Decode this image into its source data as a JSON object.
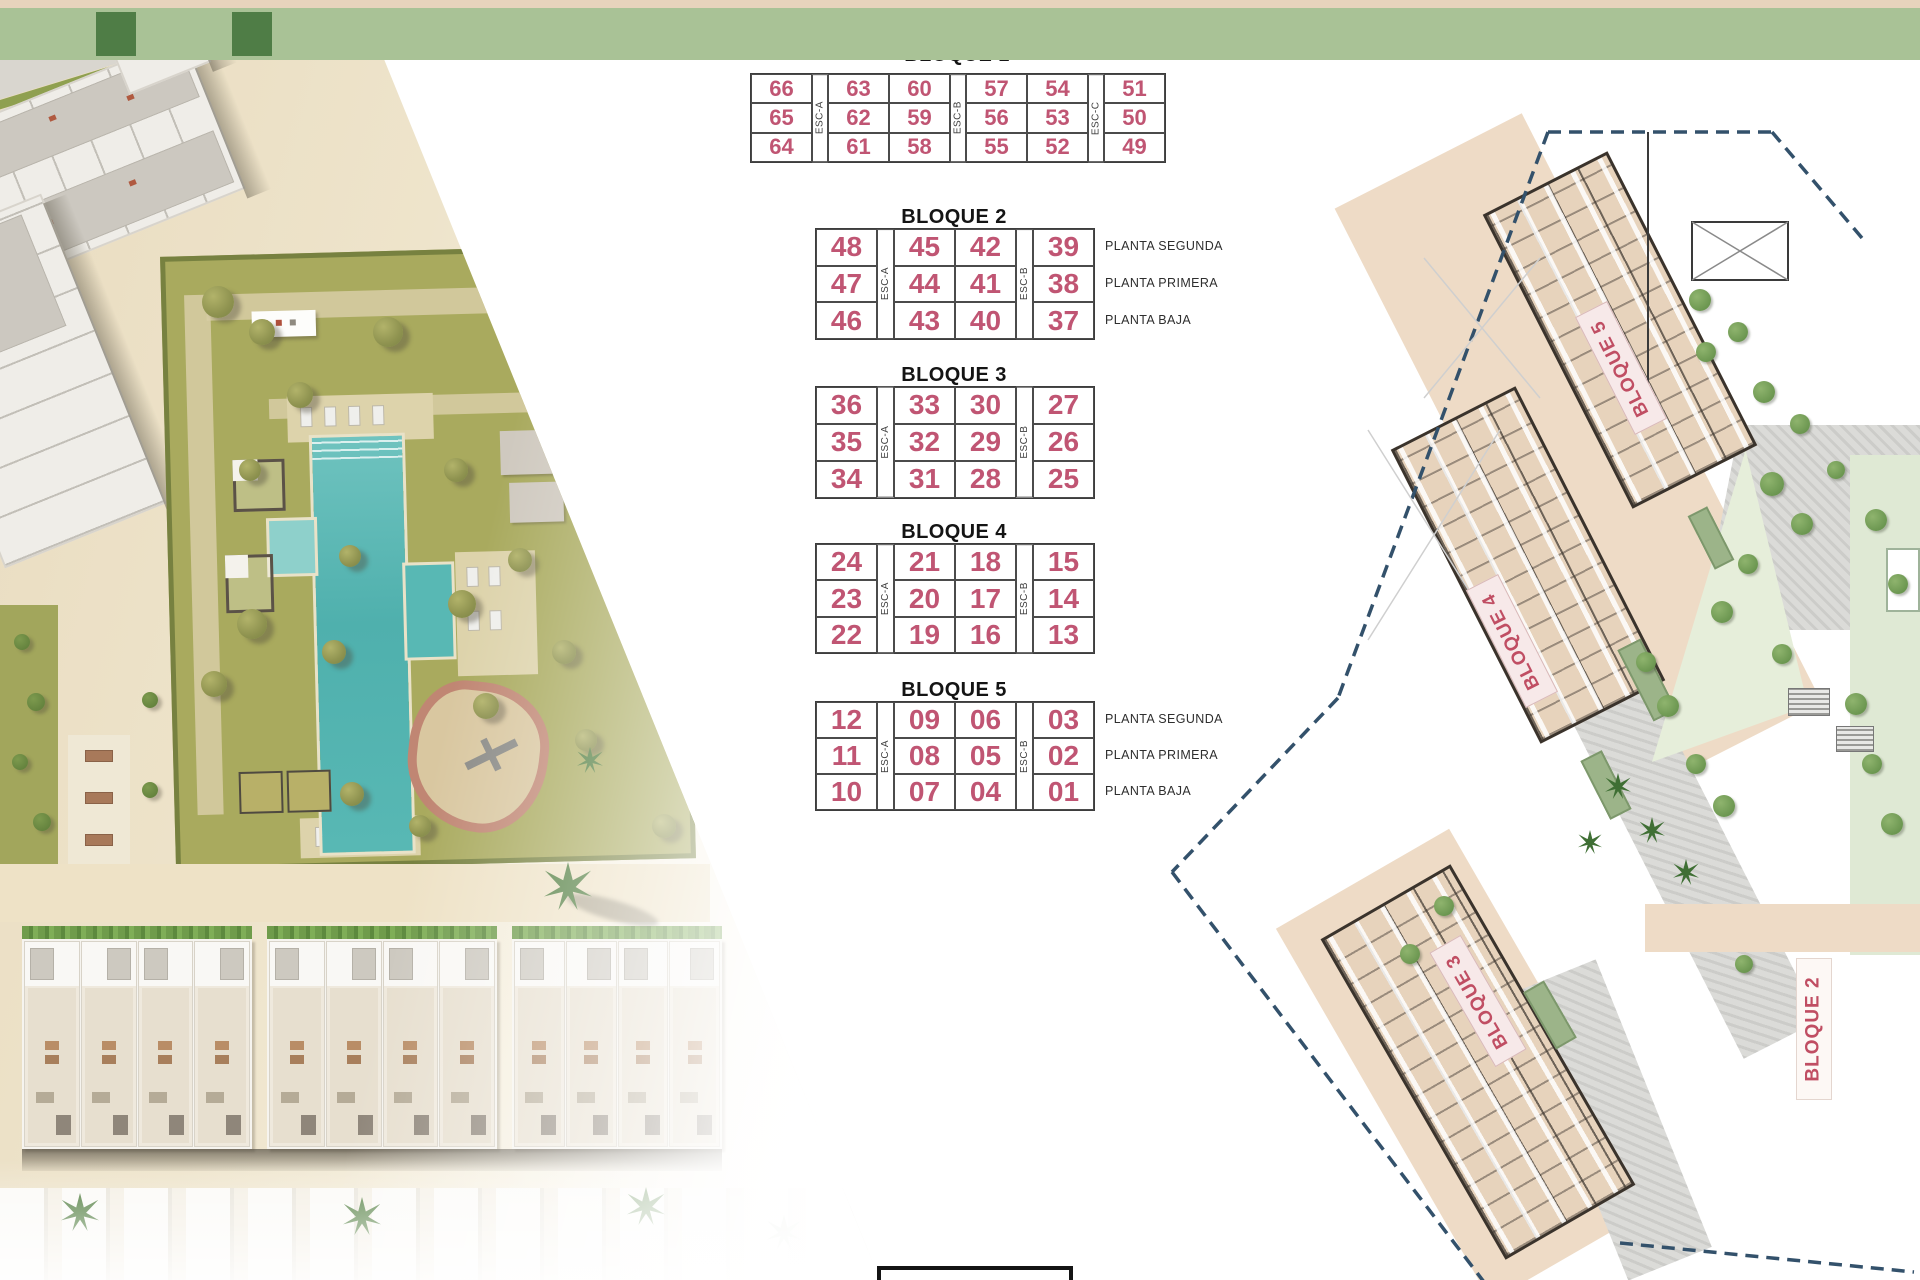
{
  "colors": {
    "accent_pink": "#c05573",
    "title_black": "#141414",
    "plan_tan": "#e7d3bc",
    "pool_turquoise": "#57b6b2",
    "boundary_navy": "#33516b",
    "lawn_green": "#a9aa5e"
  },
  "tables": {
    "bloque1": {
      "title": "BLOQUE 1",
      "esc_labels": [
        "ESC-A",
        "ESC-B",
        "ESC-C"
      ],
      "rows": [
        [
          "66",
          "63",
          "60",
          "57",
          "54",
          "51"
        ],
        [
          "65",
          "62",
          "59",
          "56",
          "53",
          "50"
        ],
        [
          "64",
          "61",
          "58",
          "55",
          "52",
          "49"
        ]
      ]
    },
    "bloque2": {
      "title": "BLOQUE 2",
      "esc_labels": [
        "ESC-A",
        "ESC-B"
      ],
      "floor_labels": [
        "PLANTA SEGUNDA",
        "PLANTA PRIMERA",
        "PLANTA BAJA"
      ],
      "rows": [
        [
          "48",
          "45",
          "42",
          "39"
        ],
        [
          "47",
          "44",
          "41",
          "38"
        ],
        [
          "46",
          "43",
          "40",
          "37"
        ]
      ]
    },
    "bloque3": {
      "title": "BLOQUE 3",
      "esc_labels": [
        "ESC-A",
        "ESC-B"
      ],
      "rows": [
        [
          "36",
          "33",
          "30",
          "27"
        ],
        [
          "35",
          "32",
          "29",
          "26"
        ],
        [
          "34",
          "31",
          "28",
          "25"
        ]
      ]
    },
    "bloque4": {
      "title": "BLOQUE 4",
      "esc_labels": [
        "ESC-A",
        "ESC-B"
      ],
      "rows": [
        [
          "24",
          "21",
          "18",
          "15"
        ],
        [
          "23",
          "20",
          "17",
          "14"
        ],
        [
          "22",
          "19",
          "16",
          "13"
        ]
      ]
    },
    "bloque5": {
      "title": "BLOQUE 5",
      "esc_labels": [
        "ESC-A",
        "ESC-B"
      ],
      "floor_labels": [
        "PLANTA SEGUNDA",
        "PLANTA PRIMERA",
        "PLANTA BAJA"
      ],
      "rows": [
        [
          "12",
          "09",
          "06",
          "03"
        ],
        [
          "11",
          "08",
          "05",
          "02"
        ],
        [
          "10",
          "07",
          "04",
          "01"
        ]
      ]
    }
  },
  "site_plan": {
    "labels": {
      "bloque5": "BLOQUE 5",
      "bloque4": "BLOQUE 4",
      "bloque3": "BLOQUE 3",
      "bloque2": "BLOQUE 2"
    }
  }
}
